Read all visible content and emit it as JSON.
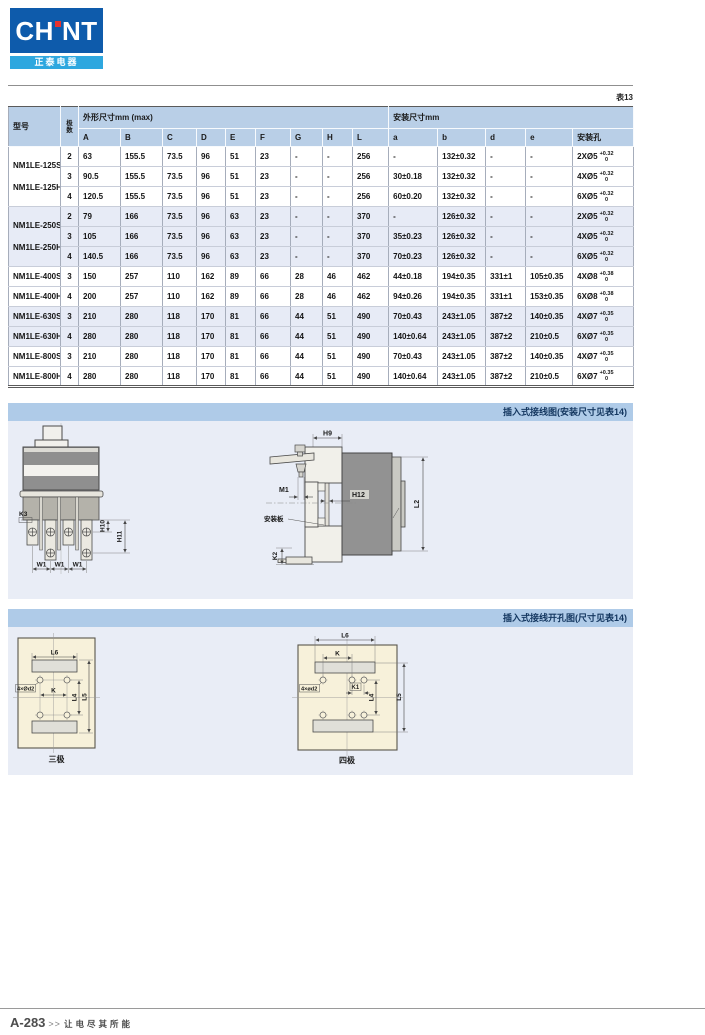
{
  "page": {
    "table_tag": "表13",
    "footer": {
      "page_no": "A-283",
      "chevrons": ">>",
      "slogan": "让电尽其所能"
    }
  },
  "logo": {
    "brand_left": "CH",
    "brand_right": "NT",
    "subtitle": "正泰电器"
  },
  "table": {
    "header": {
      "model": "型号",
      "poles_vertical": [
        "极",
        "数"
      ],
      "outline_group": "外形尺寸mm   (max)",
      "mounting_group": "安装尺寸mm",
      "outline_cols": [
        "A",
        "B",
        "C",
        "D",
        "E",
        "F",
        "G",
        "H",
        "L"
      ],
      "mounting_cols": [
        "a",
        "b",
        "d",
        "e"
      ],
      "hole_col": "安装孔"
    },
    "groups": [
      {
        "merged": true,
        "shaded": false,
        "models": [
          "NM1LE-125S",
          "NM1LE-125H"
        ],
        "rows": [
          {
            "poles": "2",
            "cells": [
              "63",
              "155.5",
              "73.5",
              "96",
              "51",
              "23",
              "-",
              "-",
              "256",
              "-",
              "132±0.32",
              "-",
              "-"
            ],
            "hole": {
              "label": "2XØ5",
              "tol_top": "+0.32",
              "tol_bottom": "0"
            }
          },
          {
            "poles": "3",
            "cells": [
              "90.5",
              "155.5",
              "73.5",
              "96",
              "51",
              "23",
              "-",
              "-",
              "256",
              "30±0.18",
              "132±0.32",
              "-",
              "-"
            ],
            "hole": {
              "label": "4XØ5",
              "tol_top": "+0.32",
              "tol_bottom": "0"
            }
          },
          {
            "poles": "4",
            "cells": [
              "120.5",
              "155.5",
              "73.5",
              "96",
              "51",
              "23",
              "-",
              "-",
              "256",
              "60±0.20",
              "132±0.32",
              "-",
              "-"
            ],
            "hole": {
              "label": "6XØ5",
              "tol_top": "+0.32",
              "tol_bottom": "0"
            }
          }
        ]
      },
      {
        "merged": true,
        "shaded": true,
        "models": [
          "NM1LE-250S",
          "NM1LE-250H"
        ],
        "rows": [
          {
            "poles": "2",
            "cells": [
              "79",
              "166",
              "73.5",
              "96",
              "63",
              "23",
              "-",
              "-",
              "370",
              "-",
              "126±0.32",
              "-",
              "-"
            ],
            "hole": {
              "label": "2XØ5",
              "tol_top": "+0.32",
              "tol_bottom": "0"
            }
          },
          {
            "poles": "3",
            "cells": [
              "105",
              "166",
              "73.5",
              "96",
              "63",
              "23",
              "-",
              "-",
              "370",
              "35±0.23",
              "126±0.32",
              "-",
              "-"
            ],
            "hole": {
              "label": "4XØ5",
              "tol_top": "+0.32",
              "tol_bottom": "0"
            }
          },
          {
            "poles": "4",
            "cells": [
              "140.5",
              "166",
              "73.5",
              "96",
              "63",
              "23",
              "-",
              "-",
              "370",
              "70±0.23",
              "126±0.32",
              "-",
              "-"
            ],
            "hole": {
              "label": "6XØ5",
              "tol_top": "+0.32",
              "tol_bottom": "0"
            }
          }
        ]
      },
      {
        "merged": false,
        "shaded": false,
        "rows": [
          {
            "model": "NM1LE-400S",
            "poles": "3",
            "cells": [
              "150",
              "257",
              "110",
              "162",
              "89",
              "66",
              "28",
              "46",
              "462",
              "44±0.18",
              "194±0.35",
              "331±1",
              "105±0.35"
            ],
            "hole": {
              "label": "4XØ8",
              "tol_top": "+0.38",
              "tol_bottom": "0"
            }
          },
          {
            "model": "NM1LE-400H",
            "poles": "4",
            "cells": [
              "200",
              "257",
              "110",
              "162",
              "89",
              "66",
              "28",
              "46",
              "462",
              "94±0.26",
              "194±0.35",
              "331±1",
              "153±0.35"
            ],
            "hole": {
              "label": "6XØ8",
              "tol_top": "+0.38",
              "tol_bottom": "0"
            }
          }
        ]
      },
      {
        "merged": false,
        "shaded": true,
        "rows": [
          {
            "model": "NM1LE-630S",
            "poles": "3",
            "cells": [
              "210",
              "280",
              "118",
              "170",
              "81",
              "66",
              "44",
              "51",
              "490",
              "70±0.43",
              "243±1.05",
              "387±2",
              "140±0.35"
            ],
            "hole": {
              "label": "4XØ7",
              "tol_top": "+0.35",
              "tol_bottom": "0"
            }
          },
          {
            "model": "NM1LE-630H",
            "poles": "4",
            "cells": [
              "280",
              "280",
              "118",
              "170",
              "81",
              "66",
              "44",
              "51",
              "490",
              "140±0.64",
              "243±1.05",
              "387±2",
              "210±0.5"
            ],
            "hole": {
              "label": "6XØ7",
              "tol_top": "+0.35",
              "tol_bottom": "0"
            }
          }
        ]
      },
      {
        "merged": false,
        "shaded": false,
        "rows": [
          {
            "model": "NM1LE-800S",
            "poles": "3",
            "cells": [
              "210",
              "280",
              "118",
              "170",
              "81",
              "66",
              "44",
              "51",
              "490",
              "70±0.43",
              "243±1.05",
              "387±2",
              "140±0.35"
            ],
            "hole": {
              "label": "4XØ7",
              "tol_top": "+0.35",
              "tol_bottom": "0"
            }
          },
          {
            "model": "NM1LE-800H",
            "poles": "4",
            "cells": [
              "280",
              "280",
              "118",
              "170",
              "81",
              "66",
              "44",
              "51",
              "490",
              "140±0.64",
              "243±1.05",
              "387±2",
              "210±0.5"
            ],
            "hole": {
              "label": "6XØ7",
              "tol_top": "+0.35",
              "tol_bottom": "0"
            }
          }
        ]
      }
    ]
  },
  "sections": {
    "wiring": {
      "title": "插入式接线图(安装尺寸见表14)",
      "front": {
        "k3": "K3",
        "h10": "H10",
        "h11": "H11",
        "w1": "W1"
      },
      "side": {
        "h9": "H9",
        "m1": "M1",
        "h12": "H12",
        "plate": "安装板",
        "k2": "K2",
        "l2": "L2"
      }
    },
    "cutout": {
      "title": "插入式接线开孔图(尺寸见表14)",
      "three_pole": {
        "caption": "三极",
        "l6": "L6",
        "d2": "4×Ød2",
        "k": "K",
        "l4": "L4",
        "l5": "L5"
      },
      "four_pole": {
        "caption": "四极",
        "l6": "L6",
        "k": "K",
        "d2": "4×ød2",
        "k1": "K1",
        "l4": "L4",
        "l5": "L5"
      }
    }
  }
}
